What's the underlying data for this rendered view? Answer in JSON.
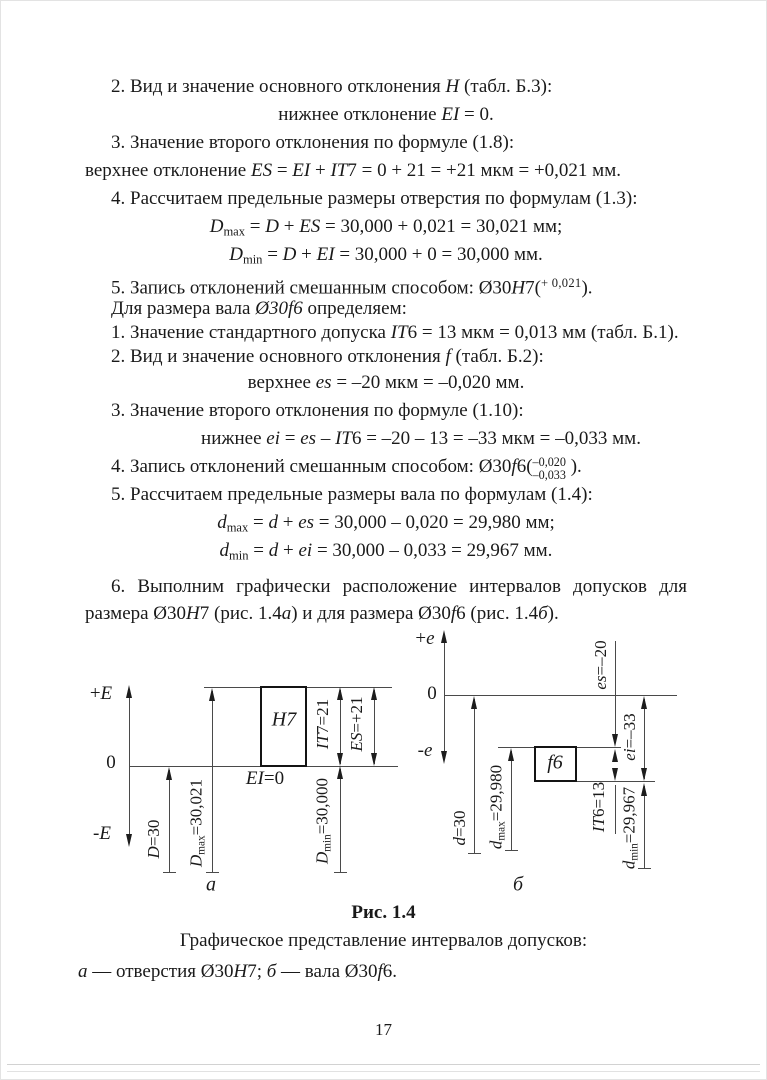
{
  "page_number": "17",
  "body_lines": [
    {
      "segs": [
        {
          "t": "2. Вид и значение основного отклонения ",
          "s": "n"
        },
        {
          "t": "H",
          "s": "i"
        },
        {
          "t": " (табл. Б.3):",
          "s": "n"
        }
      ]
    },
    {
      "segs": [
        {
          "t": "нижнее отклонение ",
          "s": "n"
        },
        {
          "t": "EI",
          "s": "i"
        },
        {
          "t": " = 0.",
          "s": "n"
        }
      ]
    },
    {
      "segs": [
        {
          "t": "3. Значение второго отклонения по формуле (1.8):",
          "s": "n"
        }
      ]
    },
    {
      "segs": [
        {
          "t": "верхнее отклонение ",
          "s": "n"
        },
        {
          "t": "ES",
          "s": "i"
        },
        {
          "t": " = ",
          "s": "n"
        },
        {
          "t": "EI",
          "s": "i"
        },
        {
          "t": " + ",
          "s": "n"
        },
        {
          "t": "IT",
          "s": "i"
        },
        {
          "t": "7 = 0 + 21 = +21 мкм = +0,021 мм.",
          "s": "n"
        }
      ]
    },
    {
      "segs": [
        {
          "t": "4. Рассчитаем предельные размеры отверстия по формулам (1.3):",
          "s": "n"
        }
      ]
    },
    {
      "segs": [
        {
          "t": "D",
          "s": "i"
        },
        {
          "t": "max",
          "s": "sub"
        },
        {
          "t": " = ",
          "s": "n"
        },
        {
          "t": "D",
          "s": "i"
        },
        {
          "t": " + ",
          "s": "n"
        },
        {
          "t": "ES",
          "s": "i"
        },
        {
          "t": " = 30,000 + 0,021 = 30,021 мм;",
          "s": "n"
        }
      ]
    },
    {
      "segs": [
        {
          "t": "D",
          "s": "i"
        },
        {
          "t": "min",
          "s": "sub"
        },
        {
          "t": " = ",
          "s": "n"
        },
        {
          "t": "D",
          "s": "i"
        },
        {
          "t": " + ",
          "s": "n"
        },
        {
          "t": "EI",
          "s": "i"
        },
        {
          "t": " = 30,000 + 0 = 30,000 мм.",
          "s": "n"
        }
      ]
    },
    {
      "segs": [
        {
          "t": "5. Запись отклонений смешанным способом: Ø30",
          "s": "n"
        },
        {
          "t": "H",
          "s": "i"
        },
        {
          "t": "7(",
          "s": "n"
        },
        {
          "t": "+ 0,021",
          "s": "sup"
        },
        {
          "t": ").",
          "s": "n"
        }
      ]
    },
    {
      "segs": [
        {
          "t": "Для размера вала ",
          "s": "n"
        },
        {
          "t": "Ø30f6",
          "s": "i"
        },
        {
          "t": " определяем:",
          "s": "n"
        }
      ]
    },
    {
      "segs": [
        {
          "t": "1. Значение стандартного допуска ",
          "s": "n"
        },
        {
          "t": "IT",
          "s": "i"
        },
        {
          "t": "6 = 13 мкм = 0,013 мм (табл. Б.1).",
          "s": "n"
        }
      ]
    },
    {
      "segs": [
        {
          "t": "2. Вид и значение основного отклонения ",
          "s": "n"
        },
        {
          "t": "f",
          "s": "i"
        },
        {
          "t": " (табл. Б.2):",
          "s": "n"
        }
      ]
    },
    {
      "segs": [
        {
          "t": "верхнее ",
          "s": "n"
        },
        {
          "t": "es",
          "s": "i"
        },
        {
          "t": " = –20 мкм = –0,020 мм.",
          "s": "n"
        }
      ]
    },
    {
      "segs": [
        {
          "t": "3. Значение второго отклонения по формуле (1.10):",
          "s": "n"
        }
      ]
    },
    {
      "segs": [
        {
          "t": "нижнее ",
          "s": "n"
        },
        {
          "t": "ei",
          "s": "i"
        },
        {
          "t": " = ",
          "s": "n"
        },
        {
          "t": "es",
          "s": "i"
        },
        {
          "t": " – ",
          "s": "n"
        },
        {
          "t": "IT",
          "s": "i"
        },
        {
          "t": "6 = –20 – 13 = –33 мкм = –0,033 мм.",
          "s": "n"
        }
      ]
    },
    {
      "segs": [
        {
          "t": "4. Запись отклонений смешанным способом: Ø30",
          "s": "n"
        },
        {
          "t": "f",
          "s": "i"
        },
        {
          "t": "6(",
          "s": "n"
        },
        {
          "stack": [
            "–0,020",
            "–0,033"
          ]
        },
        {
          "t": " ).",
          "s": "n"
        }
      ]
    },
    {
      "segs": [
        {
          "t": "5. Рассчитаем предельные размеры вала по формулам (1.4):",
          "s": "n"
        }
      ]
    },
    {
      "segs": [
        {
          "t": "d",
          "s": "i"
        },
        {
          "t": "max",
          "s": "sub"
        },
        {
          "t": " = ",
          "s": "n"
        },
        {
          "t": "d",
          "s": "i"
        },
        {
          "t": " + ",
          "s": "n"
        },
        {
          "t": "es",
          "s": "i"
        },
        {
          "t": " = 30,000 – 0,020 = 29,980 мм;",
          "s": "n"
        }
      ]
    },
    {
      "segs": [
        {
          "t": "d",
          "s": "i"
        },
        {
          "t": "min",
          "s": "sub"
        },
        {
          "t": " = ",
          "s": "n"
        },
        {
          "t": "d",
          "s": "i"
        },
        {
          "t": " + ",
          "s": "n"
        },
        {
          "t": "ei",
          "s": "i"
        },
        {
          "t": " = 30,000 – 0,033 = 29,967 мм.",
          "s": "n"
        }
      ]
    },
    {
      "segs": [
        {
          "t": "6. Выполним графически расположение интервалов допусков для размера Ø30",
          "s": "n"
        },
        {
          "t": "H",
          "s": "i"
        },
        {
          "t": "7 (рис. 1.4",
          "s": "n"
        },
        {
          "t": "а",
          "s": "i"
        },
        {
          "t": ") и для размера Ø30",
          "s": "n"
        },
        {
          "t": "f",
          "s": "i"
        },
        {
          "t": "6 (рис. 1.4",
          "s": "n"
        },
        {
          "t": "б",
          "s": "i"
        },
        {
          "t": ").",
          "s": "n"
        }
      ]
    }
  ],
  "figure": {
    "a": {
      "axis_plus": [
        {
          "t": "+",
          "s": "n"
        },
        {
          "t": "E",
          "s": "i"
        }
      ],
      "axis_zero": "0",
      "axis_minus": [
        {
          "t": "-",
          "s": "n"
        },
        {
          "t": "E",
          "s": "i"
        }
      ],
      "box_label": [
        {
          "t": "H",
          "s": "i"
        },
        {
          "t": "7",
          "s": "n"
        }
      ],
      "ei_zero": [
        {
          "t": "EI",
          "s": "i"
        },
        {
          "t": "=0",
          "s": "n"
        }
      ],
      "d": [
        {
          "t": "D",
          "s": "i"
        },
        {
          "t": "=30",
          "s": "n"
        }
      ],
      "dmax": [
        {
          "t": "D",
          "s": "i"
        },
        {
          "t": "max",
          "s": "sub"
        },
        {
          "t": "=30,021",
          "s": "n"
        }
      ],
      "dmin": [
        {
          "t": "D",
          "s": "i"
        },
        {
          "t": "min",
          "s": "sub"
        },
        {
          "t": "=30,000",
          "s": "n"
        }
      ],
      "it7": [
        {
          "t": "IT",
          "s": "i"
        },
        {
          "t": "7=21",
          "s": "n"
        }
      ],
      "es": [
        {
          "t": "ES",
          "s": "i"
        },
        {
          "t": "=+21",
          "s": "n"
        }
      ],
      "letter": [
        {
          "t": "а",
          "s": "i"
        }
      ]
    },
    "b": {
      "axis_plus": [
        {
          "t": "+",
          "s": "n"
        },
        {
          "t": "e",
          "s": "i"
        }
      ],
      "axis_zero": "0",
      "axis_minus": [
        {
          "t": "-",
          "s": "n"
        },
        {
          "t": "e",
          "s": "i"
        }
      ],
      "box_label": [
        {
          "t": "f",
          "s": "i"
        },
        {
          "t": "6",
          "s": "n"
        }
      ],
      "es": [
        {
          "t": "es",
          "s": "i"
        },
        {
          "t": "=–20",
          "s": "n"
        }
      ],
      "ei": [
        {
          "t": "ei",
          "s": "i"
        },
        {
          "t": "=–33",
          "s": "n"
        }
      ],
      "it6": [
        {
          "t": "IT",
          "s": "i"
        },
        {
          "t": "6=13",
          "s": "n"
        }
      ],
      "d": [
        {
          "t": "d",
          "s": "i"
        },
        {
          "t": "=30",
          "s": "n"
        }
      ],
      "dmax": [
        {
          "t": "d",
          "s": "i"
        },
        {
          "t": "max",
          "s": "sub"
        },
        {
          "t": "=29,980",
          "s": "n"
        }
      ],
      "dmin": [
        {
          "t": "d",
          "s": "i"
        },
        {
          "t": "min",
          "s": "sub"
        },
        {
          "t": "=29,967",
          "s": "n"
        }
      ],
      "letter": [
        {
          "t": "б",
          "s": "i"
        }
      ]
    },
    "caption_title": "Рис. 1.4",
    "caption_subtitle": "Графическое представление интервалов допусков:",
    "caption_detail": [
      {
        "t": "а",
        "s": "i"
      },
      {
        "t": " — отверстия Ø30",
        "s": "n"
      },
      {
        "t": "H",
        "s": "i"
      },
      {
        "t": "7; ",
        "s": "n"
      },
      {
        "t": "б",
        "s": "i"
      },
      {
        "t": " — вала Ø30",
        "s": "n"
      },
      {
        "t": "f",
        "s": "i"
      },
      {
        "t": "6.",
        "s": "n"
      }
    ]
  }
}
